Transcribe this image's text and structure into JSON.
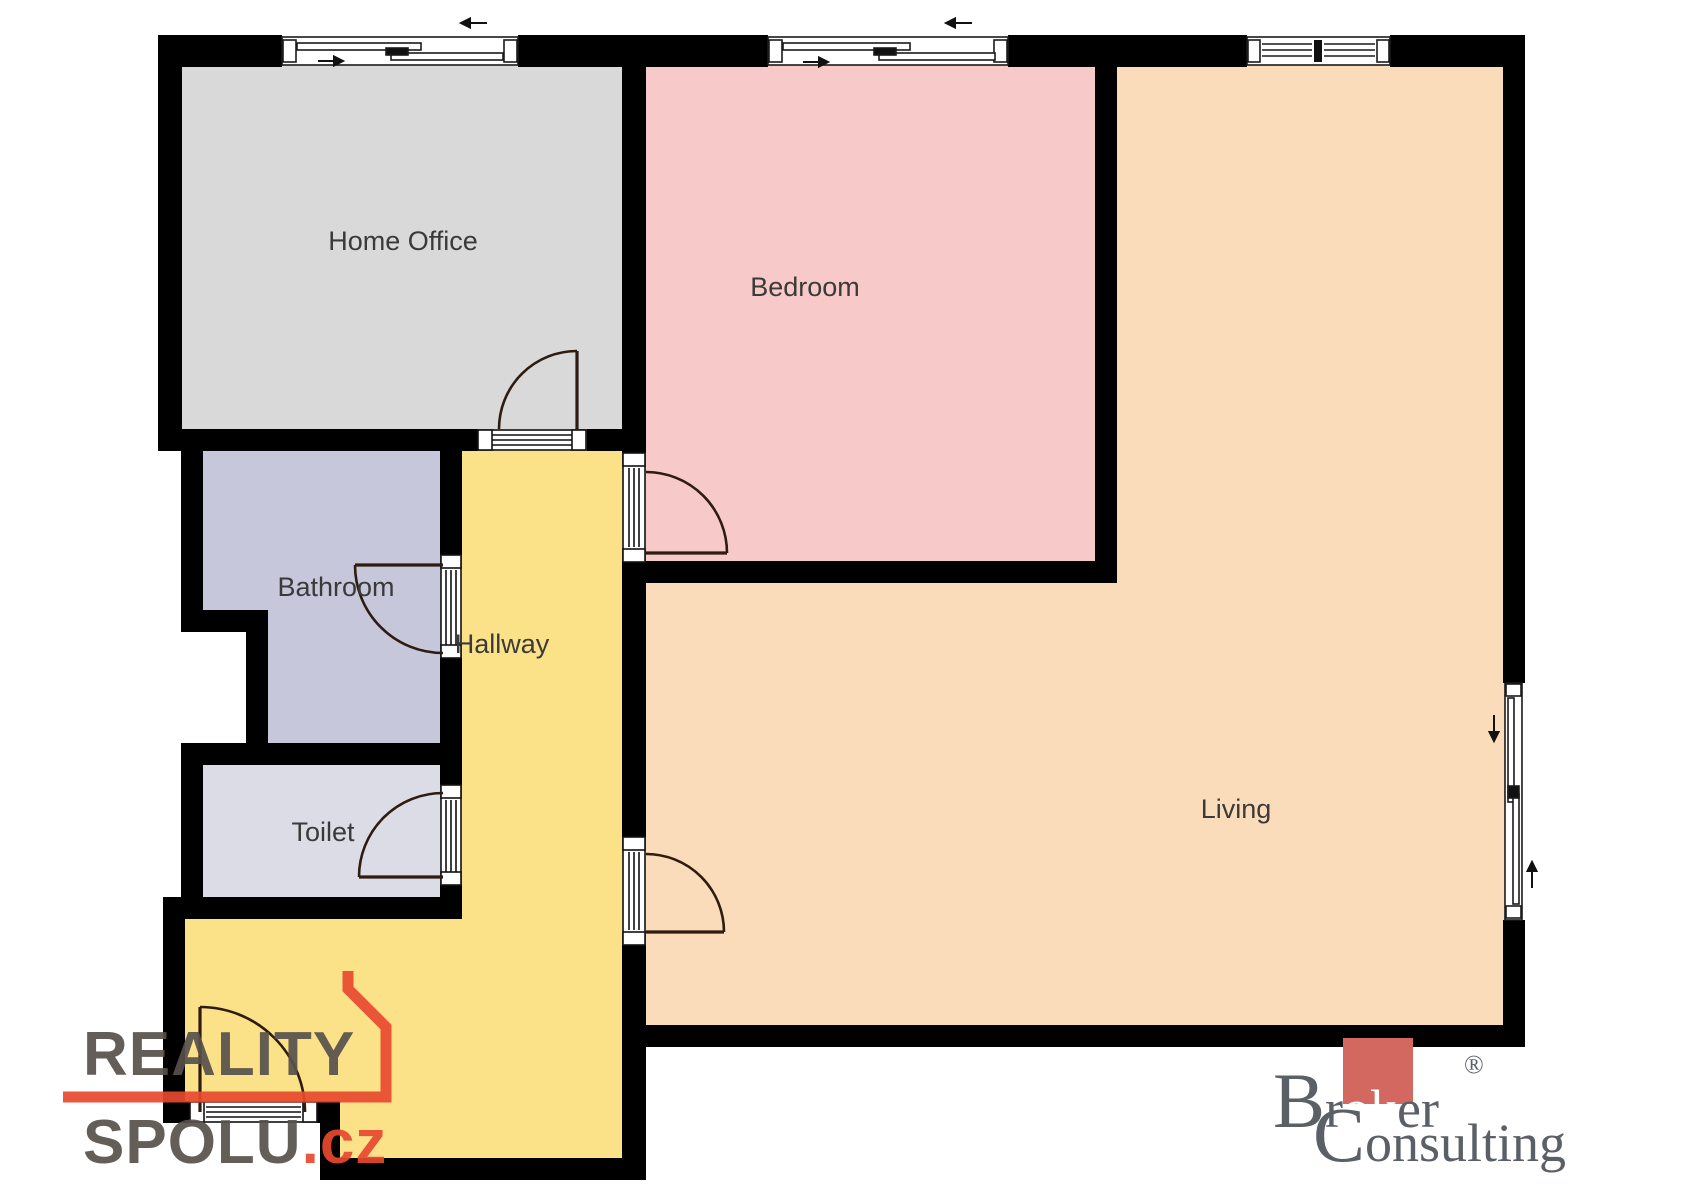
{
  "floorplan": {
    "rooms": {
      "home_office": {
        "label": "Home Office",
        "color": "#d9d9d9"
      },
      "bedroom": {
        "label": "Bedroom",
        "color": "#f8c9c9"
      },
      "living": {
        "label": "Living",
        "color": "#fbdcba"
      },
      "hallway": {
        "label": "Hallway",
        "color": "#fbe289"
      },
      "bathroom": {
        "label": "Bathroom",
        "color": "#c6c7da"
      },
      "toilet": {
        "label": "Toilet",
        "color": "#dbdce6"
      }
    },
    "wall_color": "#000000",
    "label_color": "#3a3a3a",
    "door_swing_color": "#2f1c10",
    "window_line_color": "#1a1a1a",
    "background_color": "#ffffff"
  },
  "watermarks": {
    "reality_spolu": {
      "line1": "REALITY",
      "line2": "SPOLU",
      "tld": ".cz",
      "text_color": "#57514c",
      "accent_color": "#e8492f"
    },
    "broker_consulting": {
      "word1_initial": "B",
      "word1_pre": "r",
      "word1_highlight": "ok",
      "word1_post": "er",
      "registered": "®",
      "word2_initial": "C",
      "word2_rest": "onsulting",
      "text_color": "#5b6067",
      "highlight_bg": "#d2685f",
      "highlight_text": "#ffffff"
    }
  }
}
